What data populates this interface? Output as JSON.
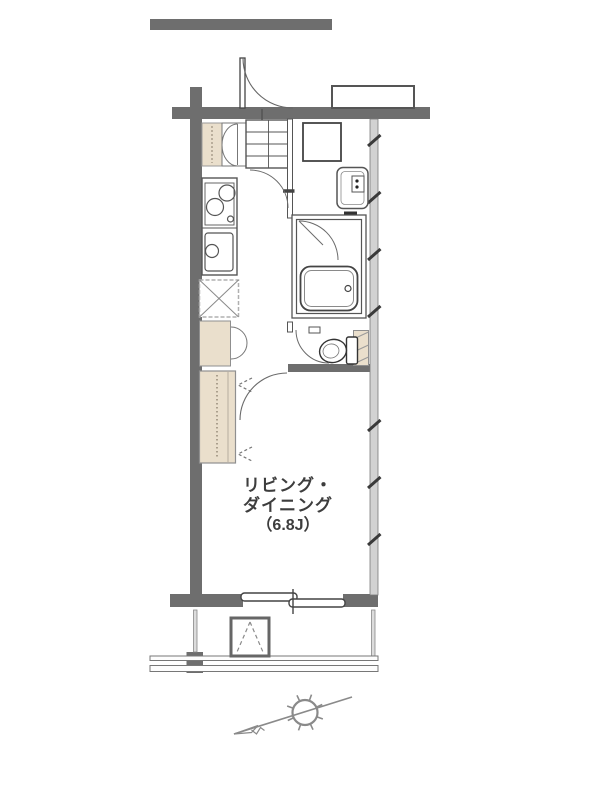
{
  "floor_plan": {
    "room_label": {
      "line1": "リビング・",
      "line2": "ダイニング",
      "line3": "（6.8J）"
    },
    "colors": {
      "wall_dark": "#6e6e6e",
      "wall_light_right": "#d2d2d2",
      "furniture_beige": "#eadfcc",
      "line_dark": "#4a4a4a",
      "line_mid": "#777777",
      "label_text": "#3d3d3d",
      "background": "#ffffff"
    },
    "fixture_names": [
      "entrance-door",
      "shoe-cabinet",
      "shoe-shelf-grid",
      "kitchen-stove",
      "kitchen-sink",
      "refrigerator-space",
      "storage-cabinet",
      "closet",
      "washing-machine-space",
      "washbasin",
      "unit-bath",
      "bathtub",
      "bath-door",
      "toilet",
      "toilet-shelf",
      "toilet-door",
      "living-dining-door",
      "sliding-window",
      "balcony-railing",
      "ac-outdoor-unit",
      "north-arrow"
    ]
  }
}
